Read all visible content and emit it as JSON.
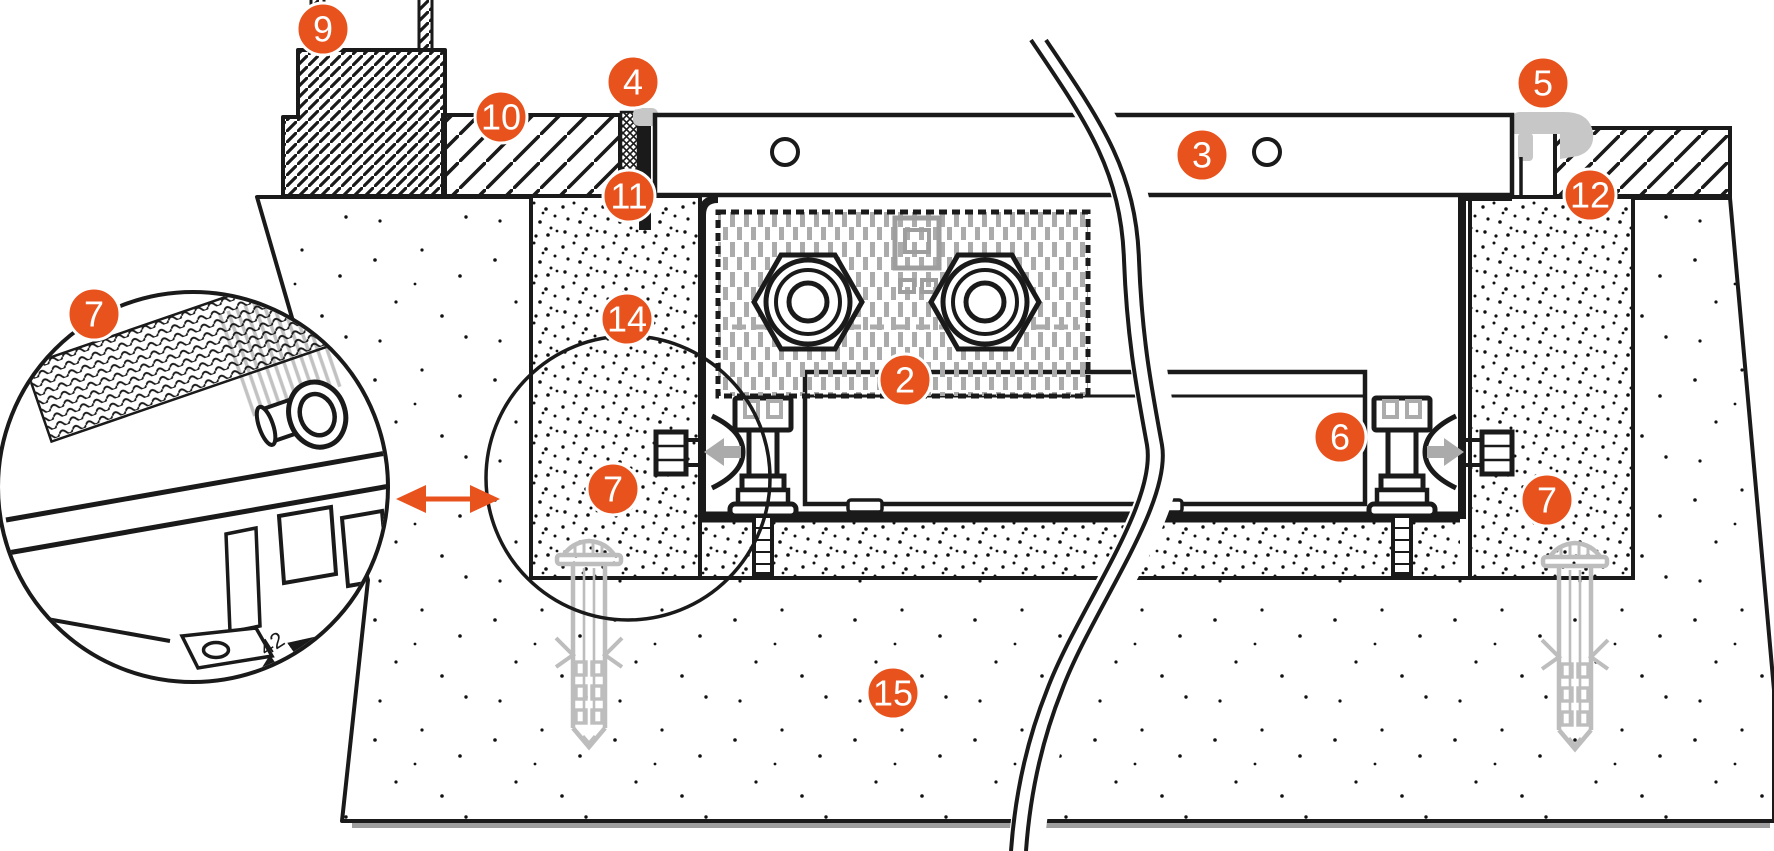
{
  "diagram": {
    "title": "trench-convector-installation-cross-section",
    "dimension_label": "42",
    "colors": {
      "accent": "#E8521D",
      "line": "#1A1A1A",
      "part_gray": "#ADADAD",
      "light_gray": "#C7C7C7",
      "shadow_gray": "#9E9E9E",
      "background": "#FFFFFF"
    },
    "callouts": [
      {
        "label": "9",
        "name": "wall-block",
        "x": 323,
        "y": 29
      },
      {
        "label": "4",
        "name": "edge-profile-left",
        "x": 633,
        "y": 82
      },
      {
        "label": "5",
        "name": "edge-profile-right",
        "x": 1543,
        "y": 83
      },
      {
        "label": "10",
        "name": "floor-finish-left",
        "x": 501,
        "y": 117
      },
      {
        "label": "3",
        "name": "grille-cover",
        "x": 1202,
        "y": 155
      },
      {
        "label": "11",
        "name": "tub-rim-left",
        "x": 629,
        "y": 196
      },
      {
        "label": "12",
        "name": "floor-finish-right",
        "x": 1590,
        "y": 195
      },
      {
        "label": "7",
        "name": "bracket-detail",
        "x": 94,
        "y": 314
      },
      {
        "label": "14",
        "name": "edge-insulation",
        "x": 627,
        "y": 319
      },
      {
        "label": "2",
        "name": "heat-exchanger",
        "x": 905,
        "y": 380
      },
      {
        "label": "6",
        "name": "adjustable-foot",
        "x": 1340,
        "y": 437
      },
      {
        "label": "7",
        "name": "wall-bracket-left",
        "x": 613,
        "y": 489
      },
      {
        "label": "7",
        "name": "wall-bracket-right",
        "x": 1547,
        "y": 500
      },
      {
        "label": "15",
        "name": "concrete-slab",
        "x": 893,
        "y": 693
      }
    ]
  }
}
